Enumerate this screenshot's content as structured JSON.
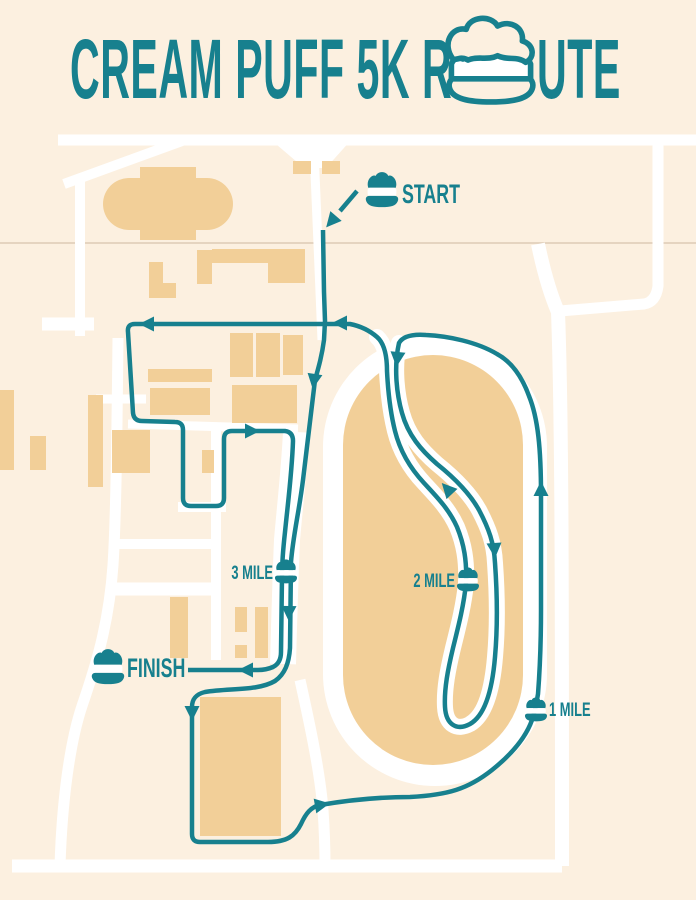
{
  "title": {
    "full_text": "CREAM PUFF 5K ROUTE",
    "text_before_icon": "CREAM PUFF 5K R",
    "text_after_icon": "UTE",
    "icon": "cream-puff-icon"
  },
  "markers": {
    "start": {
      "label": "START",
      "icon": "cream-puff-icon"
    },
    "finish": {
      "label": "FINISH",
      "icon": "cream-puff-icon"
    },
    "mile_1": {
      "label": "1 MILE",
      "icon": "cream-puff-icon"
    },
    "mile_2": {
      "label": "2 MILE",
      "icon": "cream-puff-icon"
    },
    "mile_3": {
      "label": "3 MILE",
      "icon": "cream-puff-icon"
    }
  },
  "colors": {
    "route_teal": "#17808E",
    "background_cream": "#FCF0E0",
    "building_tan": "#F2CF98",
    "road_white": "#FFFFFF",
    "faint_line": "#DDCAB5"
  }
}
